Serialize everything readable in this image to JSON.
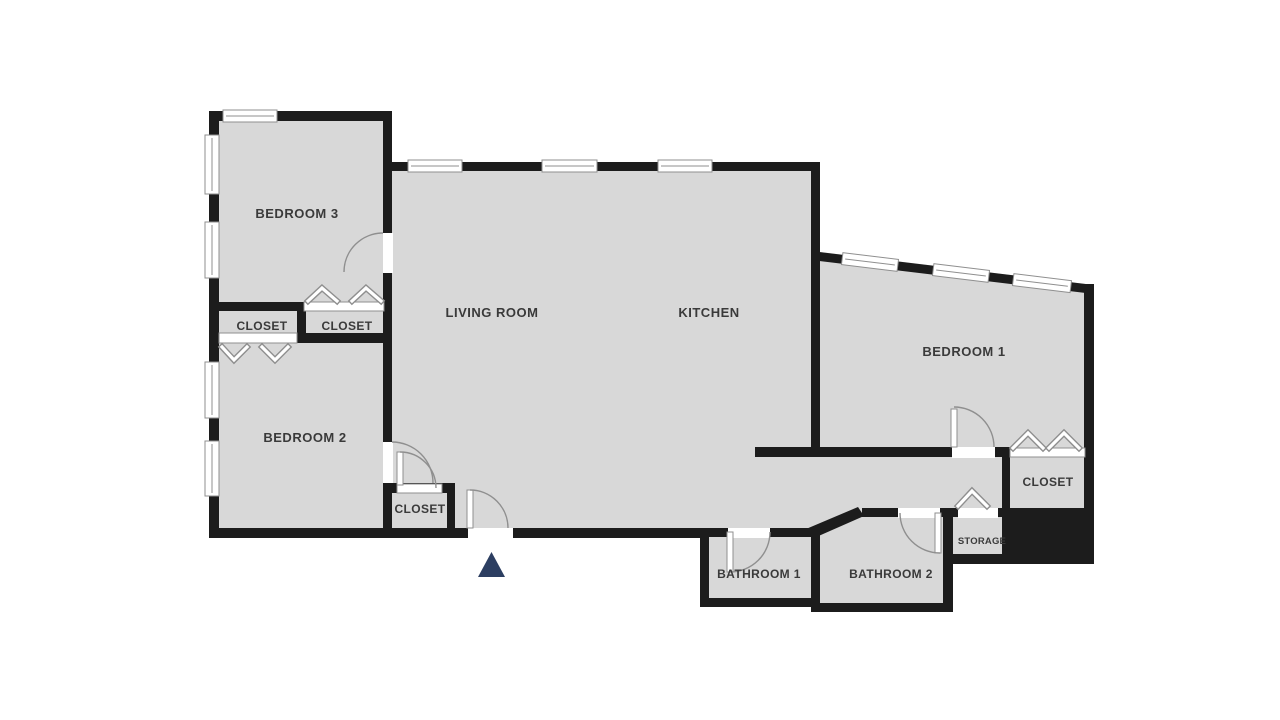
{
  "colors": {
    "background": "#ffffff",
    "floor": "#d8d8d8",
    "wall": "#1c1c1c",
    "label": "#3a3a3a",
    "line": "#8f8f8f",
    "entry_marker": "#2c3e61"
  },
  "labels": {
    "bedroom3": "BEDROOM 3",
    "closet_bedroom3": "CLOSET",
    "closet_bedroom2": "CLOSET",
    "bedroom2": "BEDROOM 2",
    "living_room": "LIVING ROOM",
    "kitchen": "KITCHEN",
    "bedroom1": "BEDROOM 1",
    "closet_bedroom1": "CLOSET",
    "storage": "STORAGE",
    "bathroom1": "BATHROOM 1",
    "bathroom2": "BATHROOM 2",
    "closet_hall": "CLOSET"
  },
  "icons": {
    "entry_marker": "triangle-up-icon",
    "door": "quarter-arc-swing-icon",
    "bifold_door": "chevron-icon",
    "window": "double-line-window-icon"
  }
}
